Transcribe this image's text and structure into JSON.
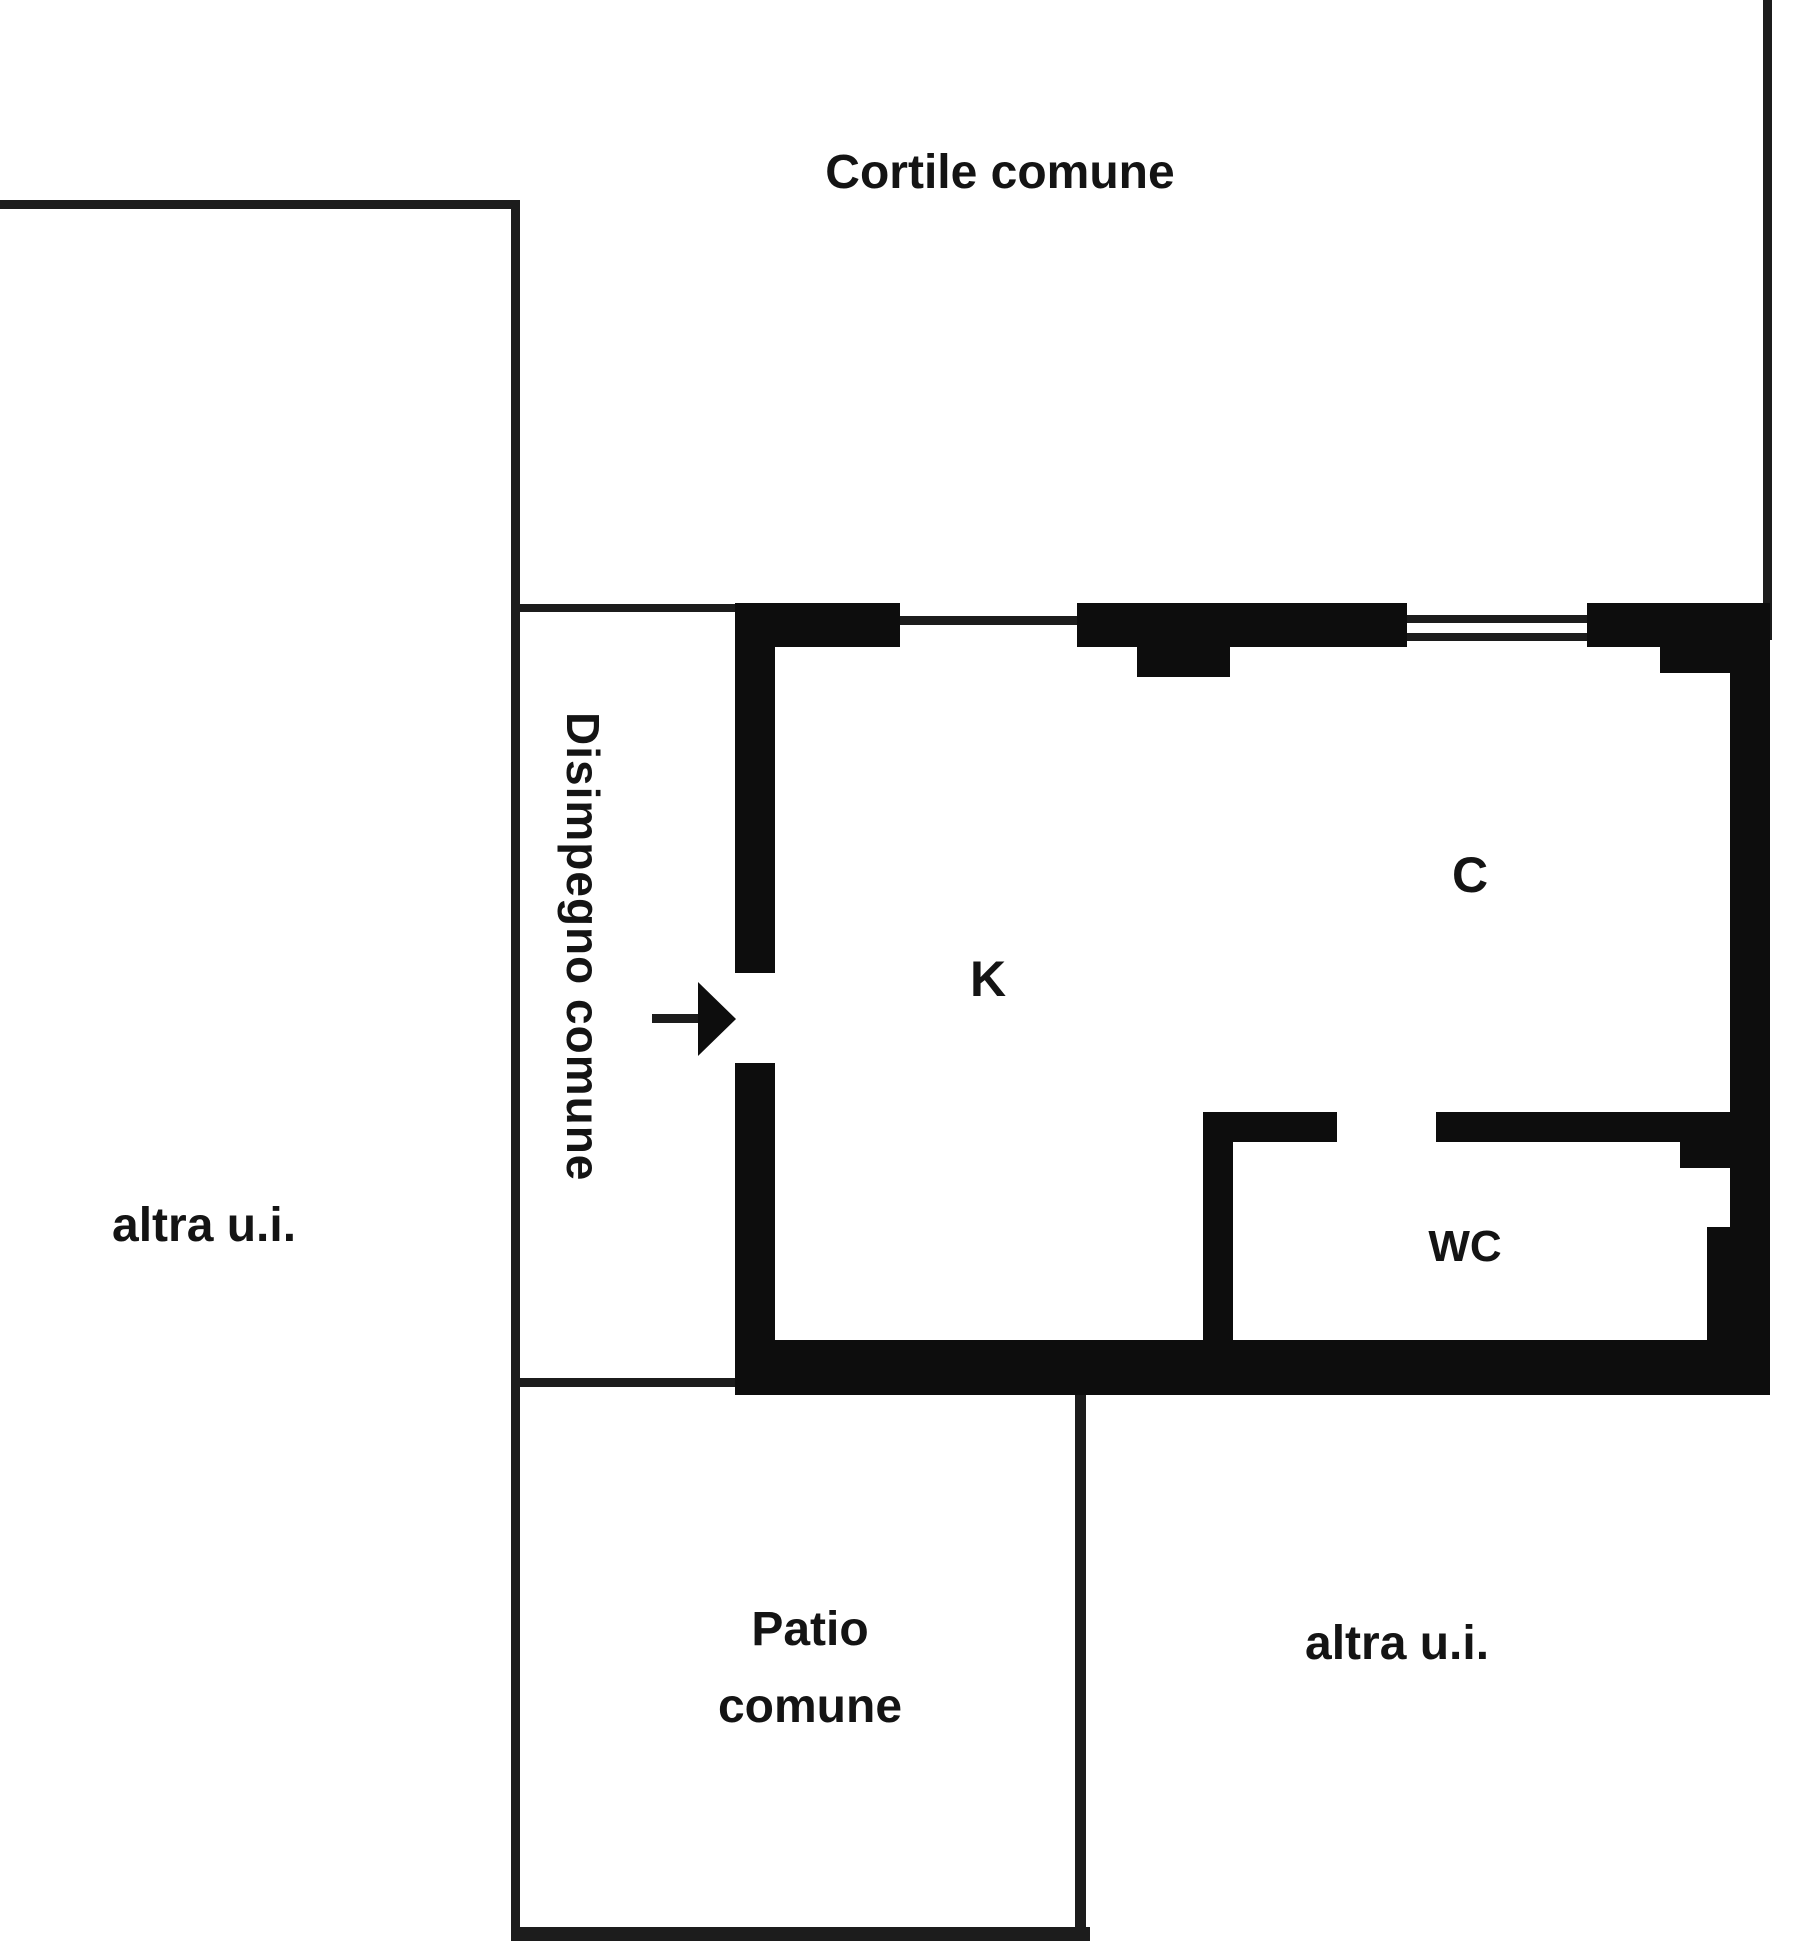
{
  "plan": {
    "title": "floor-plan",
    "areas": {
      "cortile": {
        "label": "Cortile comune"
      },
      "altra_left": {
        "label": "altra u.i."
      },
      "disimpegno": {
        "label": "Disimpegno comune"
      },
      "kitchen": {
        "label": "K"
      },
      "room_c": {
        "label": "C"
      },
      "wc": {
        "label": "WC"
      },
      "patio": {
        "label": "Patio comune"
      },
      "altra_bottom": {
        "label": "altra u.i."
      }
    },
    "colors": {
      "wall": "#0d0d0d",
      "line": "#1c1c1c",
      "background": "#ffffff",
      "text": "#141414"
    }
  }
}
